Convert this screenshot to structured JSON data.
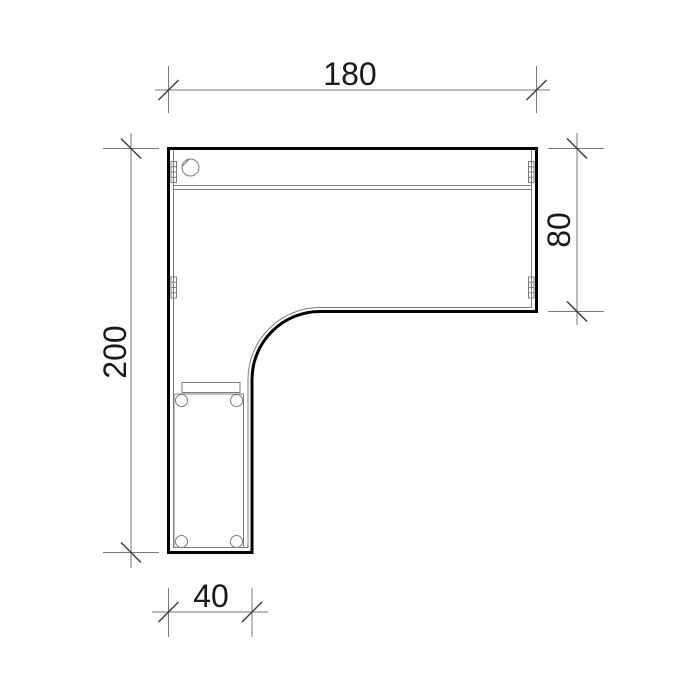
{
  "drawing": {
    "type": "technical-plan-view",
    "subject": "l-shaped-corner-desk-top-view",
    "dimensions": {
      "top": {
        "label": "180"
      },
      "right": {
        "label": "80"
      },
      "left": {
        "label": "200"
      },
      "bottom": {
        "label": "40"
      }
    }
  },
  "colors": {
    "background": "#ffffff",
    "outline": "#000000",
    "thin-line": "#7d7d7d",
    "dim-line": "#7a7a7a",
    "tick": "#3f3f3f",
    "text": "#1a1a1a"
  }
}
